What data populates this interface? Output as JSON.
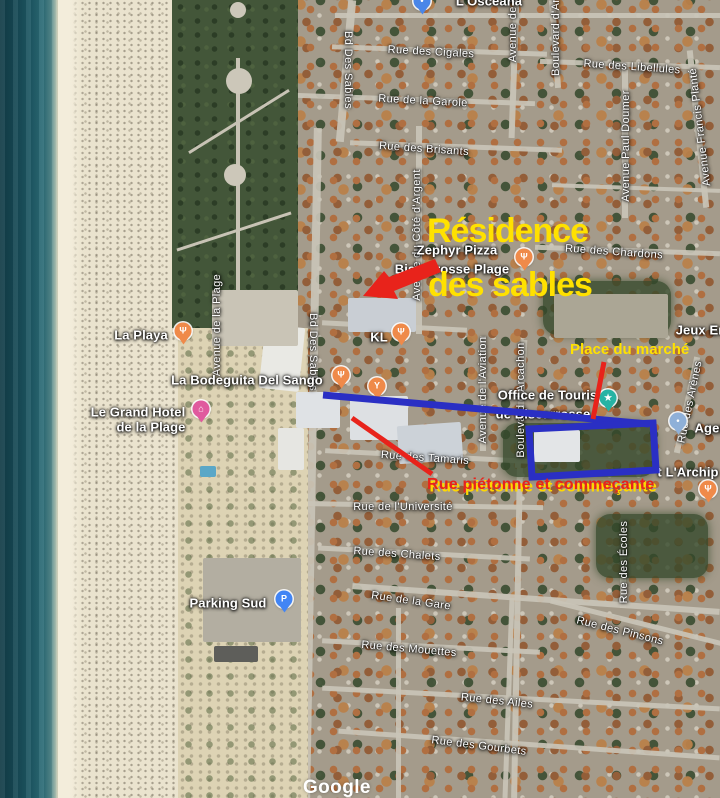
{
  "annotations": {
    "residence_line1": "Résidence",
    "residence_line2": "des sables",
    "place_du_marche": "Place du marché",
    "rue_pietonne": "Rue piétonne et commeçante",
    "colors": {
      "yellow": "#ffe100",
      "red": "#e8231b",
      "blue": "#2a2fc4"
    }
  },
  "watermark": "Google",
  "map": {
    "labels": [
      {
        "text": "Rue des Cigales",
        "x": 431,
        "y": 52,
        "rot": 3
      },
      {
        "text": "Rue de la Garole",
        "x": 423,
        "y": 101,
        "rot": 3
      },
      {
        "text": "Rue des Libellules",
        "x": 632,
        "y": 67,
        "rot": 4
      },
      {
        "text": "Rue des Brisants",
        "x": 424,
        "y": 149,
        "rot": 4
      },
      {
        "text": "Rue des Chardons",
        "x": 614,
        "y": 252,
        "rot": 4
      },
      {
        "text": "Rue des Tamaris",
        "x": 425,
        "y": 458,
        "rot": 4
      },
      {
        "text": "Rue de l'Université",
        "x": 403,
        "y": 507
      },
      {
        "text": "Rue des Chalets",
        "x": 397,
        "y": 554,
        "rot": 4
      },
      {
        "text": "Rue de la Gare",
        "x": 411,
        "y": 601,
        "rot": 8
      },
      {
        "text": "Rue des Mouettes",
        "x": 409,
        "y": 649,
        "rot": 5
      },
      {
        "text": "Rue des Pinsons",
        "x": 620,
        "y": 631,
        "rot": 14
      },
      {
        "text": "Rue des Ailes",
        "x": 497,
        "y": 701,
        "rot": 6
      },
      {
        "text": "Rue des Gourbets",
        "x": 479,
        "y": 746,
        "rot": 7
      },
      {
        "text": "Bd Des Sables",
        "x": 348,
        "y": 70,
        "dir": "down"
      },
      {
        "text": "Bd Des Sables",
        "x": 313,
        "y": 352,
        "dir": "down"
      },
      {
        "text": "Avenue de l'A",
        "x": 513,
        "y": 26,
        "dir": "up"
      },
      {
        "text": "Boulevard d'Arg",
        "x": 556,
        "y": 34,
        "dir": "up"
      },
      {
        "text": "Avenue Paul Doumer",
        "x": 626,
        "y": 146,
        "dir": "up"
      },
      {
        "text": "Avenue Francis Planté",
        "x": 700,
        "y": 127,
        "dir": "up",
        "rot": -7
      },
      {
        "text": "Avenue du Côté d'Argent",
        "x": 417,
        "y": 235,
        "dir": "up"
      },
      {
        "text": "Avenue de la Plage",
        "x": 217,
        "y": 325,
        "dir": "up"
      },
      {
        "text": "Avenue de l'Aviation",
        "x": 483,
        "y": 390,
        "dir": "up"
      },
      {
        "text": "Boulevard d'Arcachon",
        "x": 521,
        "y": 400,
        "dir": "up"
      },
      {
        "text": "Rue des Arènes",
        "x": 690,
        "y": 402,
        "dir": "up",
        "rot": 12
      },
      {
        "text": "Rue des Écoles",
        "x": 624,
        "y": 562,
        "dir": "up"
      },
      {
        "text": "L'Oscéana",
        "x": 489,
        "y": 1,
        "style": "poi"
      },
      {
        "text": "Zephyr Pizza",
        "x": 457,
        "y": 250,
        "style": "poi"
      },
      {
        "text": "Biscarrosse Plage",
        "x": 452,
        "y": 269,
        "style": "poi"
      },
      {
        "text": "La Playa",
        "x": 141,
        "y": 335,
        "style": "poi"
      },
      {
        "text": "KL",
        "x": 379,
        "y": 337,
        "style": "poi"
      },
      {
        "text": "La Bodeguita Del Sango",
        "x": 247,
        "y": 380,
        "style": "poi"
      },
      {
        "text": "Le Grand Hotel",
        "x": 138,
        "y": 412,
        "style": "poi"
      },
      {
        "text": "de la Plage",
        "x": 151,
        "y": 427,
        "style": "poi"
      },
      {
        "text": "Office de Tourisme",
        "x": 557,
        "y": 395,
        "style": "poi"
      },
      {
        "text": "de Biscarrosse",
        "x": 543,
        "y": 414,
        "style": "poi"
      },
      {
        "text": "Agen",
        "x": 711,
        "y": 428,
        "style": "poi"
      },
      {
        "text": "t L'Archip",
        "x": 688,
        "y": 472,
        "style": "poi"
      },
      {
        "text": "Parking Sud",
        "x": 228,
        "y": 603,
        "style": "poi"
      },
      {
        "text": "Jeux En",
        "x": 701,
        "y": 330,
        "style": "poi"
      }
    ],
    "pins": [
      {
        "type": "place",
        "x": 422,
        "y": 1
      },
      {
        "type": "food",
        "x": 524,
        "y": 257
      },
      {
        "type": "food",
        "x": 183,
        "y": 331
      },
      {
        "type": "food",
        "x": 401,
        "y": 332
      },
      {
        "type": "food",
        "x": 341,
        "y": 375
      },
      {
        "type": "bar",
        "x": 377,
        "y": 386
      },
      {
        "type": "hotel",
        "x": 201,
        "y": 409
      },
      {
        "type": "tourism",
        "x": 608,
        "y": 398
      },
      {
        "type": "place_light",
        "x": 678,
        "y": 421
      },
      {
        "type": "parking",
        "x": 284,
        "y": 599
      },
      {
        "type": "food",
        "x": 708,
        "y": 489
      }
    ],
    "pin_colors": {
      "food": "#ef8a4a",
      "bar": "#ef8a4a",
      "hotel": "#e05a9e",
      "tourism": "#27b3a4",
      "place": "#4a86e8",
      "place_light": "#8fb0d8",
      "parking": "#4285f4"
    },
    "pin_glyphs": {
      "food": "Ψ",
      "bar": "Y",
      "hotel": "⌂",
      "tourism": "★",
      "place": "•",
      "place_light": "•",
      "parking": "P"
    }
  }
}
